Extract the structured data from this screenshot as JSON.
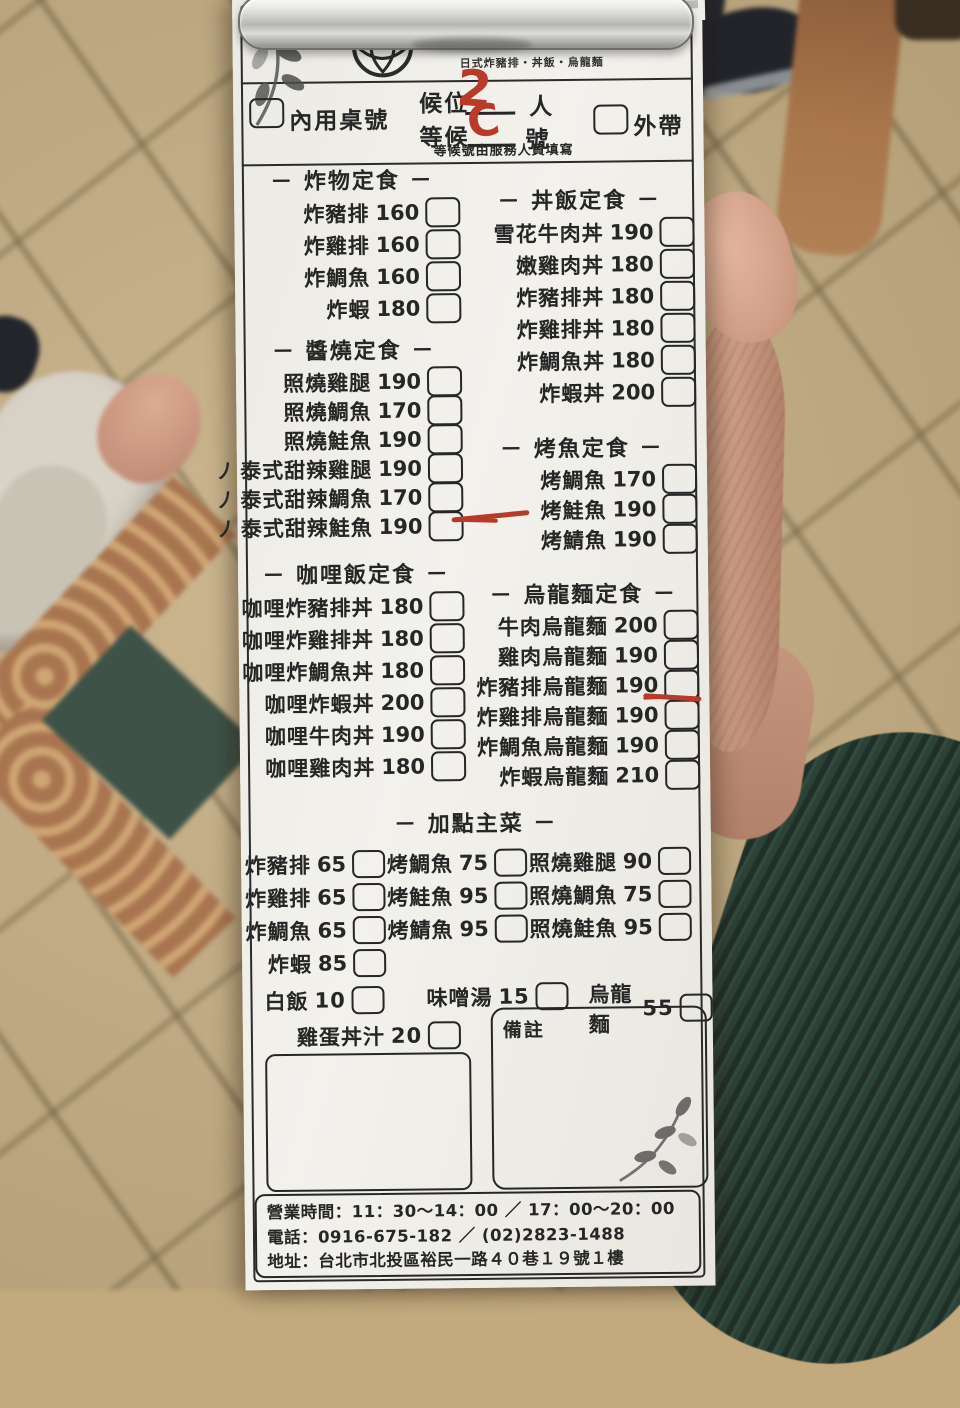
{
  "restaurant": {
    "name": "和幸廣定食",
    "tagline": "日式炸豬排・丼飯・烏龍麵"
  },
  "order_header": {
    "party_label": "候位",
    "party_unit": "人",
    "party_value_handwritten": "2",
    "dine_in_label": "內用桌號",
    "wait_label": "等候",
    "wait_unit": "號",
    "wait_value_handwritten": "C",
    "takeout_label": "外帶",
    "note": "等候號由服務人員填寫"
  },
  "icons": {
    "spicy_glyph": "ノ"
  },
  "colors": {
    "red_annotation": "#b73a2a",
    "paper": "#f0eee9",
    "ink": "#262626",
    "sleeve_green": "#2c4237",
    "floor_tan": "#c6ae83"
  },
  "sections": {
    "fried": {
      "title": "－ 炸物定食 －",
      "items": [
        {
          "name": "炸豬排",
          "price": "160"
        },
        {
          "name": "炸雞排",
          "price": "160"
        },
        {
          "name": "炸鯛魚",
          "price": "160"
        },
        {
          "name": "炸蝦",
          "price": "180"
        }
      ]
    },
    "teriyaki": {
      "title": "－ 醬燒定食 －",
      "items": [
        {
          "name": "照燒雞腿",
          "price": "190"
        },
        {
          "name": "照燒鯛魚",
          "price": "170"
        },
        {
          "name": "照燒鮭魚",
          "price": "190"
        },
        {
          "name": "泰式甜辣雞腿",
          "price": "190",
          "spicy": true
        },
        {
          "name": "泰式甜辣鯛魚",
          "price": "170",
          "spicy": true
        },
        {
          "name": "泰式甜辣鮭魚",
          "price": "190",
          "spicy": true,
          "marked": true
        }
      ]
    },
    "curry": {
      "title": "－ 咖哩飯定食 －",
      "items": [
        {
          "name": "咖哩炸豬排丼",
          "price": "180"
        },
        {
          "name": "咖哩炸雞排丼",
          "price": "180"
        },
        {
          "name": "咖哩炸鯛魚丼",
          "price": "180"
        },
        {
          "name": "咖哩炸蝦丼",
          "price": "200"
        },
        {
          "name": "咖哩牛肉丼",
          "price": "190"
        },
        {
          "name": "咖哩雞肉丼",
          "price": "180"
        }
      ]
    },
    "donburi": {
      "title": "－ 丼飯定食 －",
      "items": [
        {
          "name": "雪花牛肉丼",
          "price": "190"
        },
        {
          "name": "嫩雞肉丼",
          "price": "180"
        },
        {
          "name": "炸豬排丼",
          "price": "180"
        },
        {
          "name": "炸雞排丼",
          "price": "180"
        },
        {
          "name": "炸鯛魚丼",
          "price": "180"
        },
        {
          "name": "炸蝦丼",
          "price": "200"
        }
      ]
    },
    "grilled_fish": {
      "title": "－ 烤魚定食 －",
      "items": [
        {
          "name": "烤鯛魚",
          "price": "170"
        },
        {
          "name": "烤鮭魚",
          "price": "190"
        },
        {
          "name": "烤鯖魚",
          "price": "190"
        }
      ]
    },
    "udon": {
      "title": "－ 烏龍麵定食 －",
      "items": [
        {
          "name": "牛肉烏龍麵",
          "price": "200"
        },
        {
          "name": "雞肉烏龍麵",
          "price": "190"
        },
        {
          "name": "炸豬排烏龍麵",
          "price": "190",
          "marked": true
        },
        {
          "name": "炸雞排烏龍麵",
          "price": "190"
        },
        {
          "name": "炸鯛魚烏龍麵",
          "price": "190"
        },
        {
          "name": "炸蝦烏龍麵",
          "price": "210"
        }
      ]
    },
    "extras": {
      "title": "－ 加點主菜 －",
      "items": [
        {
          "name": "炸豬排",
          "price": "65"
        },
        {
          "name": "烤鯛魚",
          "price": "75"
        },
        {
          "name": "照燒雞腿",
          "price": "90"
        },
        {
          "name": "炸雞排",
          "price": "65"
        },
        {
          "name": "烤鮭魚",
          "price": "95"
        },
        {
          "name": "照燒鯛魚",
          "price": "75"
        },
        {
          "name": "炸鯛魚",
          "price": "65"
        },
        {
          "name": "烤鯖魚",
          "price": "95"
        },
        {
          "name": "照燒鮭魚",
          "price": "95"
        },
        {
          "name": "炸蝦",
          "price": "85"
        }
      ]
    },
    "sides": {
      "items": [
        {
          "name": "白飯",
          "price": "10"
        },
        {
          "name": "味噌湯",
          "price": "15"
        },
        {
          "name": "烏龍麵",
          "price": "55"
        }
      ]
    },
    "egg_sauce": {
      "name": "雞蛋丼汁",
      "price": "20"
    },
    "notes_label": "備註"
  },
  "footer": {
    "hours": "營業時間：11：30～14：00 ／ 17：00～20：00",
    "phone": "電話：0916-675-182 ／ (02)2823-1488",
    "address": "地址：台北市北投區裕民一路４０巷１９號１樓"
  }
}
